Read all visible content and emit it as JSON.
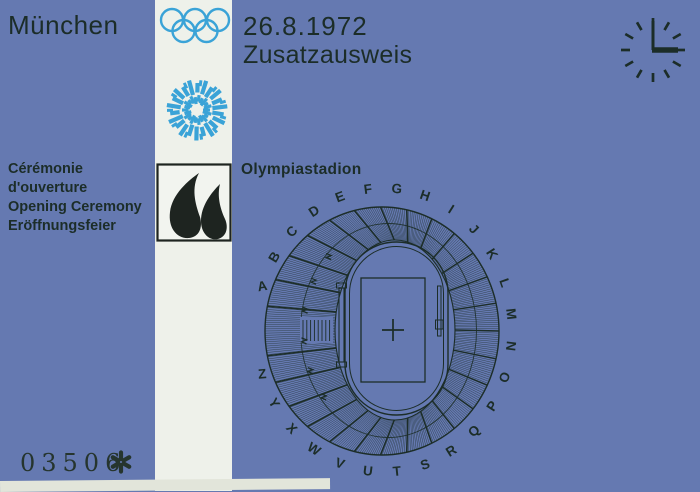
{
  "ticket": {
    "city": "München",
    "date": "26.8.1972",
    "type": "Zusatzausweis",
    "event": {
      "lines": [
        "Cérémonie",
        "d'ouverture",
        "Opening Ceremony",
        "Eröffnungsfeier"
      ]
    },
    "venue": "Olympiastadion",
    "serial": "03506",
    "clock_time": "3:00",
    "stadium_sections": [
      "A",
      "B",
      "C",
      "D",
      "E",
      "F",
      "G",
      "H",
      "I",
      "J",
      "K",
      "L",
      "M",
      "N",
      "O",
      "P",
      "Q",
      "R",
      "S",
      "T",
      "U",
      "V",
      "W",
      "X",
      "Y",
      "Z"
    ],
    "icons": {
      "rings": "olympic-rings-icon",
      "emblem": "munich-1972-spiral-emblem-icon",
      "pictogram": "olympic-flame-pictogram-icon",
      "clock": "clock-icon",
      "asterisk": "asterisk-icon"
    },
    "colors": {
      "ticket_blue": "#6579b1",
      "ink": "#1c2d28",
      "light_blue": "#3aa3d7",
      "stripe_white": "#eef1ea",
      "pictogram_black": "#1e2420"
    }
  }
}
